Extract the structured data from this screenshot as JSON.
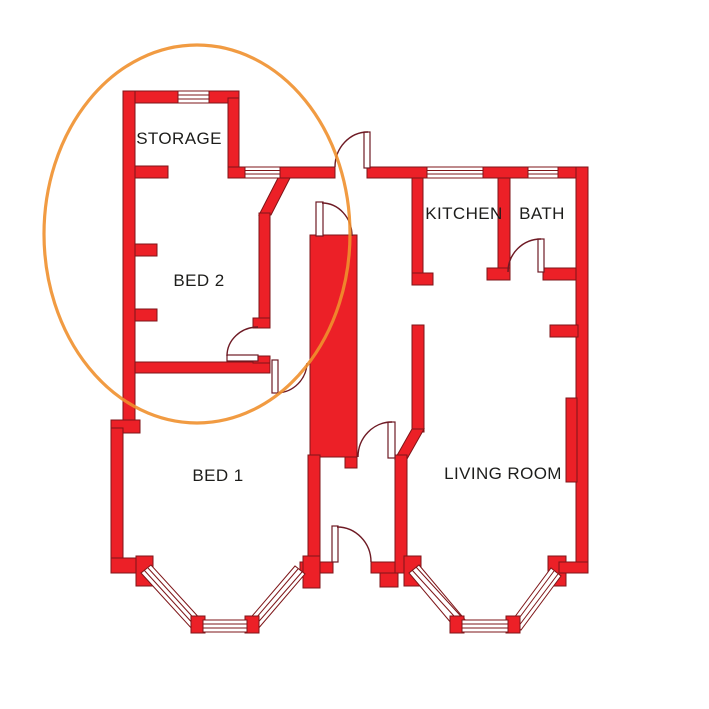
{
  "canvas": {
    "width": 709,
    "height": 709,
    "background": "#FFFFFF"
  },
  "colors": {
    "canvas_bg": "#FFFFFF",
    "wall_fill": "#EC2027",
    "wall_outline": "#7E1518",
    "door_line": "#6E1A24",
    "annotation": "#F0902E",
    "label_text": "#1D1D1B"
  },
  "annotation": {
    "type": "ellipse-highlight",
    "color": "#F0902E"
  },
  "rooms": [
    {
      "id": "storage",
      "label": "STORAGE"
    },
    {
      "id": "bed-2",
      "label": "BED 2"
    },
    {
      "id": "bed-1",
      "label": "BED 1"
    },
    {
      "id": "kitchen",
      "label": "KITCHEN"
    },
    {
      "id": "bath",
      "label": "BATH"
    },
    {
      "id": "living-room",
      "label": "LIVING ROOM"
    }
  ]
}
